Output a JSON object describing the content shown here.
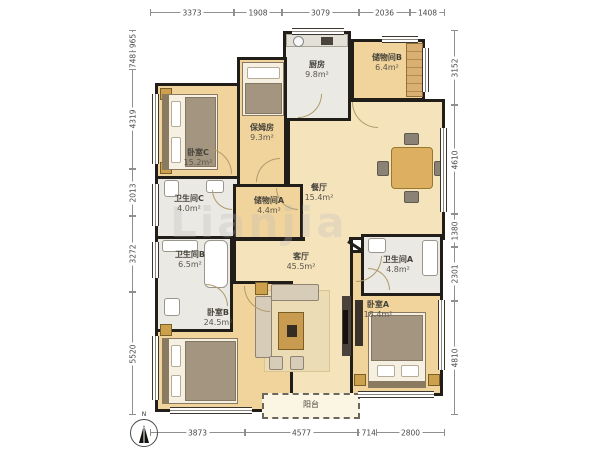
{
  "watermark": "Lianjia",
  "compass": {
    "label": "N"
  },
  "colors": {
    "wall": "#211d18",
    "wood_floor": "#f1d49c",
    "hall_floor": "#f5e3bc",
    "tile_floor": "#ebe9e3",
    "balcony_floor": "#fbf5e3",
    "dimension_text": "#4a4a4a"
  },
  "dims": {
    "top": [
      "3373",
      "1908",
      "3079",
      "2036",
      "1408"
    ],
    "bottom": [
      "3873",
      "4577",
      "714",
      "2800"
    ],
    "left": [
      "965",
      "748",
      "4319",
      "2013",
      "3272",
      "5520"
    ],
    "right": [
      "3152",
      "4610",
      "1380",
      "2301",
      "4810"
    ]
  },
  "rooms": [
    {
      "name": "卧室C",
      "area": "15.2m²"
    },
    {
      "name": "保姆房",
      "area": "9.3m²"
    },
    {
      "name": "厨房",
      "area": "9.8m²"
    },
    {
      "name": "储物间B",
      "area": "6.4m²"
    },
    {
      "name": "卫生间C",
      "area": "4.0m²"
    },
    {
      "name": "储物间A",
      "area": "4.4m²"
    },
    {
      "name": "餐厅",
      "area": "15.4m²"
    },
    {
      "name": "卫生间B",
      "area": "6.5m²"
    },
    {
      "name": "客厅",
      "area": "45.5m²"
    },
    {
      "name": "卧室B",
      "area": "24.5m²"
    },
    {
      "name": "卫生间A",
      "area": "4.8m²"
    },
    {
      "name": "卧室A",
      "area": "18.4m²"
    },
    {
      "name": "阳台",
      "area": ""
    }
  ]
}
